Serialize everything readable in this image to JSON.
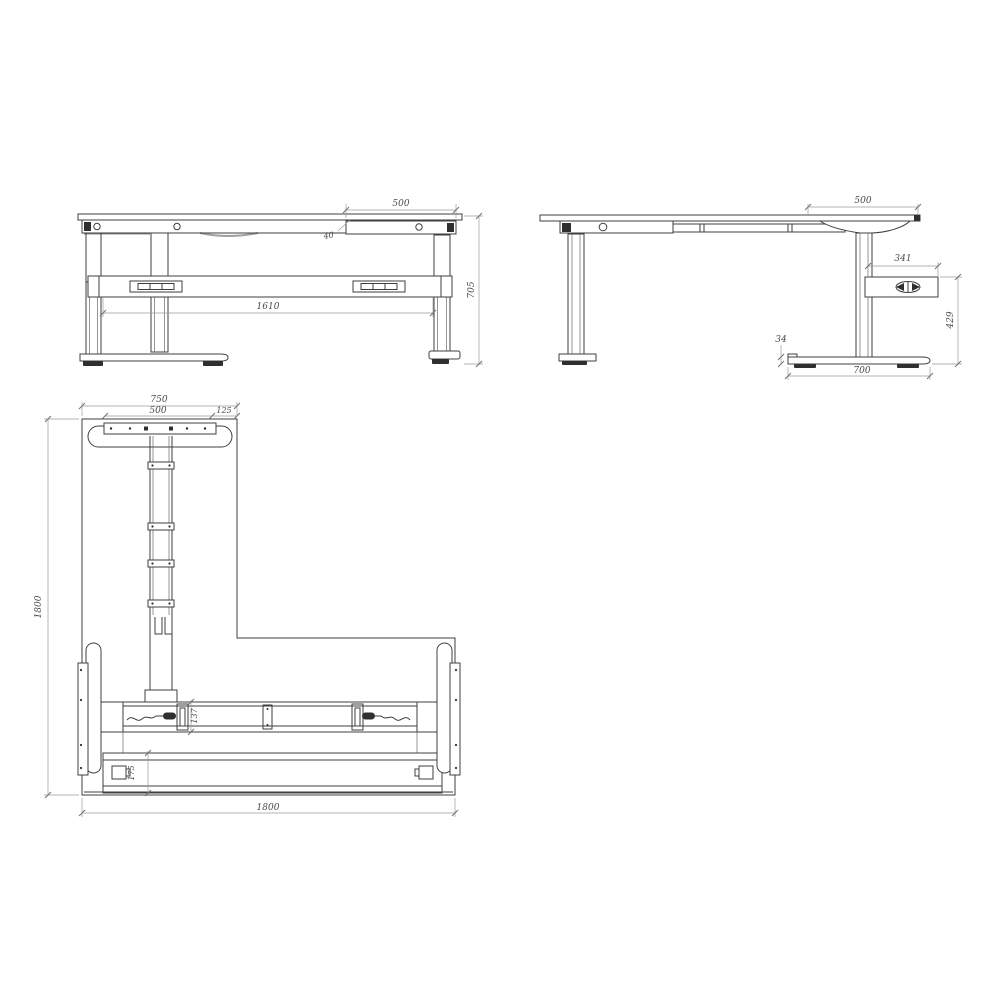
{
  "drawing": {
    "colors": {
      "background": "#ffffff",
      "part_line": "#3f3f3f",
      "dimension_line": "#9a9a9a",
      "dimension_text": "#4a4a4a",
      "dark_fill": "#2f2f2f"
    },
    "views": {
      "front": {
        "dimensions": {
          "overhang": "500",
          "inset": "40",
          "leg_span": "1610",
          "height": "705"
        }
      },
      "side": {
        "dimensions": {
          "overhang": "500",
          "control_box_length": "341",
          "control_box_floor_height": "429",
          "foot_thickness": "34",
          "foot_length": "700"
        }
      },
      "plan": {
        "dimensions": {
          "foot_span": "750",
          "plate_span": "500",
          "side_offset": "125",
          "depth": "1800",
          "beam_depth": "137",
          "tray_depth": "175",
          "width": "1800"
        }
      }
    }
  }
}
